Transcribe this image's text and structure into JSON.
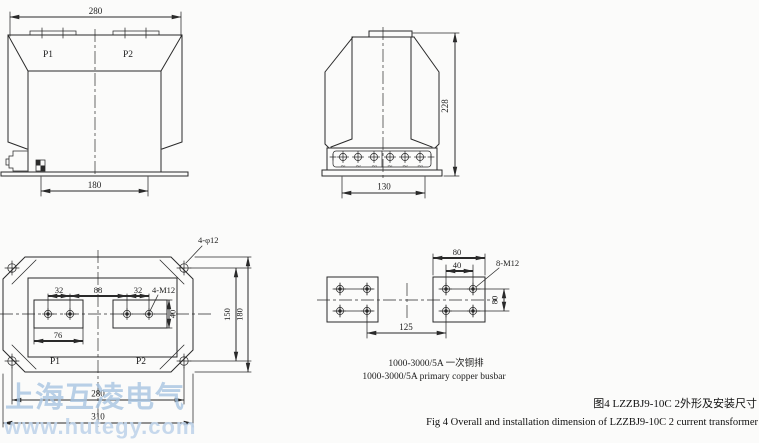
{
  "watermark": {
    "company": "上海互凌电气",
    "website": "www.hutegy.com"
  },
  "figure_caption": {
    "zh": "图4 LZZBJ9-10C 2外形及安装尺寸",
    "en": "Fig 4 Overall and installation dimension of LZZBJ9-10C  2 current transformer"
  },
  "front_view": {
    "dim_width_top": "280",
    "dim_width_bottom": "180",
    "terminal_p1": "P1",
    "terminal_p2": "P2"
  },
  "side_view": {
    "dim_height": "228",
    "dim_terminal_span": "130",
    "secondary_terminals": [
      "1S1",
      "1S2",
      "1S3",
      "2S1",
      "2S2",
      "2S3"
    ]
  },
  "plan_view": {
    "mounting_hole_callout": "4-φ12",
    "dim_hole_pitch_left": "32",
    "dim_hole_pitch_center": "88",
    "dim_hole_pitch_right": "32",
    "thread_callout": "4-M12",
    "dim_pad_width": "76",
    "dim_pad_height": "40",
    "dim_mount_pitch_vertical": "150",
    "dim_flange_depth": "180",
    "dim_mount_pitch_horizontal": "280",
    "dim_flange_width": "310",
    "terminal_p1": "P1",
    "terminal_p2": "P2"
  },
  "busbar_view": {
    "dim_plate_width": "80",
    "dim_hole_pitch_horizontal": "40",
    "thread_callout": "8-M12",
    "dim_hole_pitch_vertical": "80",
    "dim_center_distance": "125",
    "caption_zh": "1000-3000/5A 一次铜排",
    "caption_en": "1000-3000/5A primary copper busbar"
  },
  "colors": {
    "line": "#2a2a2a",
    "watermark_primary": "#a7c4e1",
    "watermark_secondary": "#c0d4ea",
    "background": "#fbfbfa"
  }
}
